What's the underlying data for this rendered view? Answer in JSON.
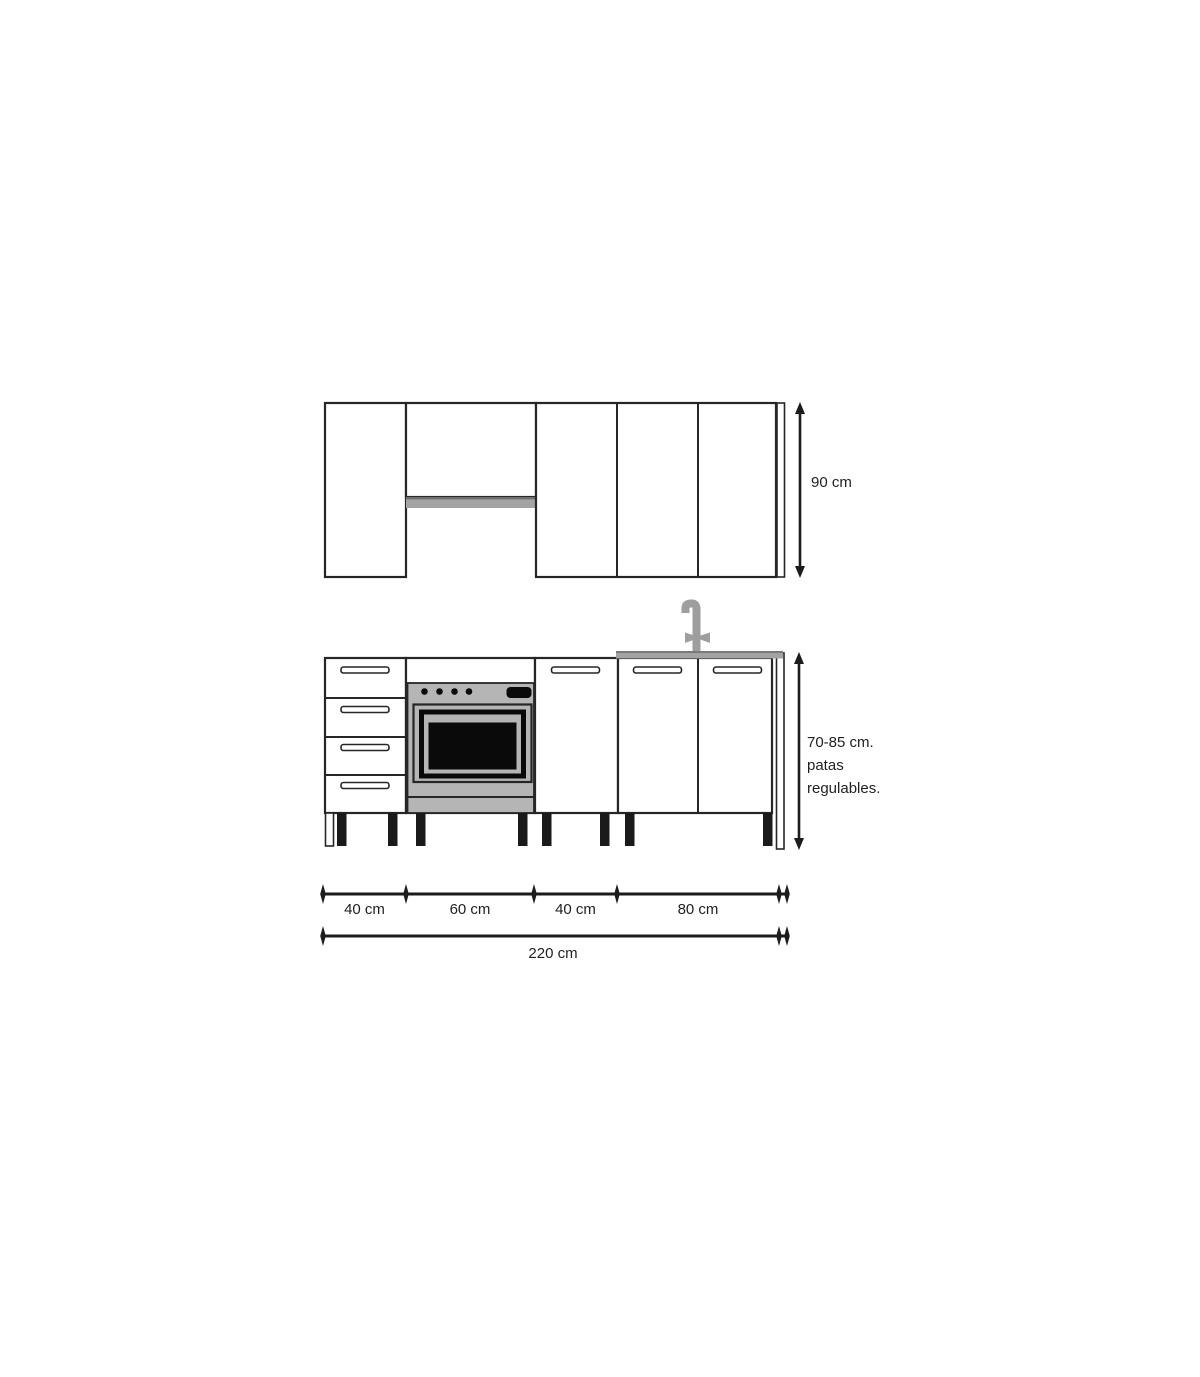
{
  "colors": {
    "outline": "#262626",
    "dim": "#1c1c1c",
    "text": "#1f1f1f",
    "shelf_gray": "#a3a3a3",
    "shelf_gray_edge": "#6e6e6e",
    "countertop_gray": "#a3a3a3",
    "countertop_edge": "#7a7a7a",
    "faucet_gray": "#9e9e9e",
    "oven_gray": "#b5b5b5",
    "appliance_black": "#0a0a0a",
    "leg_black": "#1a1a1a"
  },
  "labels": {
    "upper_height": "90 cm",
    "base_height_line1": "70-85 cm.",
    "base_height_line2": "patas",
    "base_height_line3": "regulables.",
    "width_segment_1": "40 cm",
    "width_segment_2": "60 cm",
    "width_segment_3": "40 cm",
    "width_segment_4": "80 cm",
    "total_width": "220 cm"
  }
}
